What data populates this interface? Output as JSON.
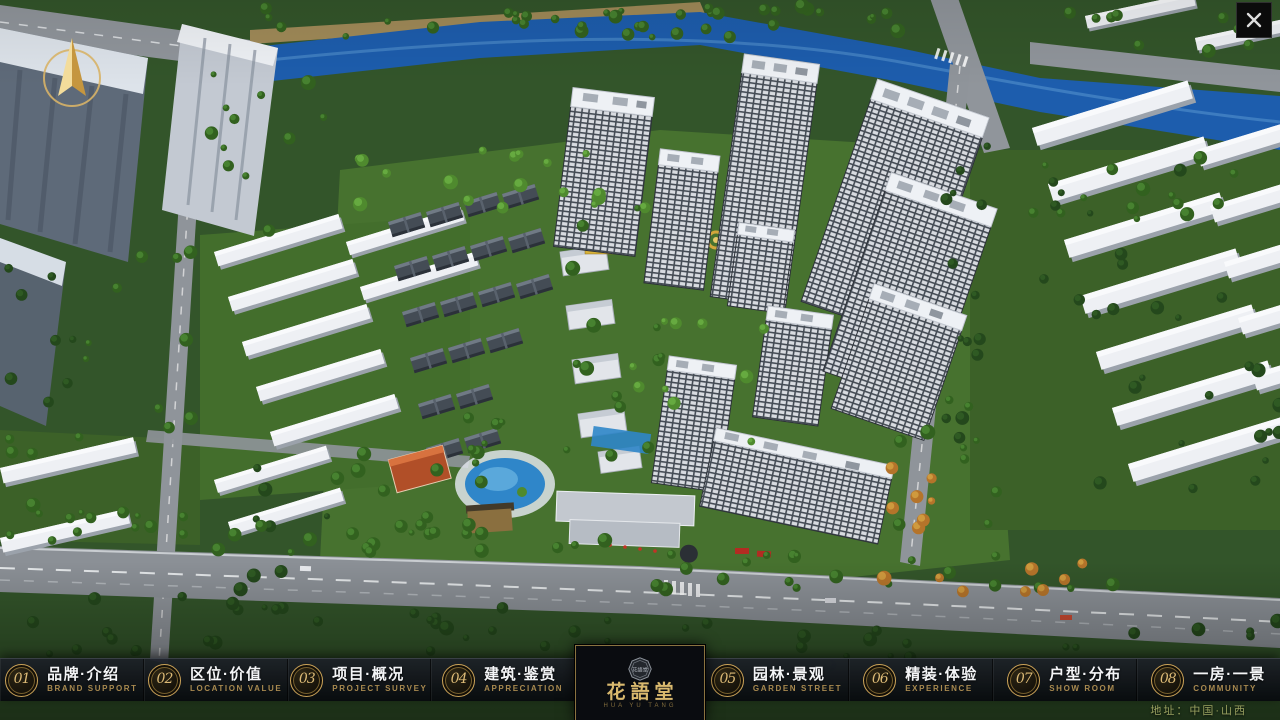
{
  "window": {
    "close_icon": "✕",
    "compass_icon": "north-arrow"
  },
  "logo": {
    "title": "花語堂",
    "subtitle": "HUA YU TANG",
    "emblem_text": "花語堂"
  },
  "nav": {
    "items": [
      {
        "num": "01",
        "cn": "品牌·介绍",
        "en": "BRAND SUPPORT"
      },
      {
        "num": "02",
        "cn": "区位·价值",
        "en": "LOCATION VALUE"
      },
      {
        "num": "03",
        "cn": "项目·概况",
        "en": "PROJECT SURVEY"
      },
      {
        "num": "04",
        "cn": "建筑·鉴赏",
        "en": "APPRECIATION"
      },
      {
        "num": "05",
        "cn": "园林·景观",
        "en": "GARDEN STREET"
      },
      {
        "num": "06",
        "cn": "精装·体验",
        "en": "EXPERIENCE"
      },
      {
        "num": "07",
        "cn": "户型·分布",
        "en": "SHOW ROOM"
      },
      {
        "num": "08",
        "cn": "一房·一景",
        "en": "COMMUNITY"
      }
    ]
  },
  "footer": {
    "address": "地址：中国·山西"
  },
  "colors": {
    "gold": "#c9a25e",
    "navbar_bg": "#0a0d12",
    "address_text": "#9aa261",
    "river": "#1d5dad"
  }
}
